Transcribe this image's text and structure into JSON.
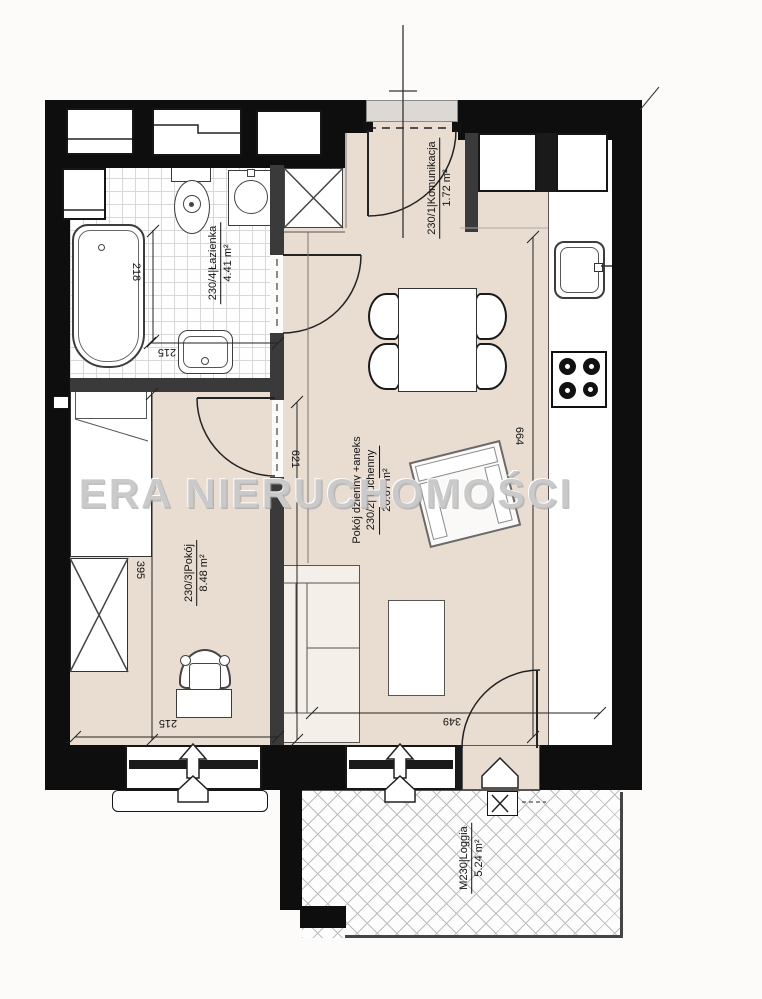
{
  "watermark": {
    "text": "ERA NIERUCHOMOŚCI"
  },
  "rooms": {
    "komunikacja": {
      "label": "230/1|Komunikacja",
      "area": "1.72 m²"
    },
    "living": {
      "label_line1": "Pokój dzienny +aneks",
      "label_line2": "230/2| kuchenny",
      "area": "20.67 m²"
    },
    "pokoj": {
      "label": "230/3|Pokój",
      "area": "8.48 m²"
    },
    "bathroom": {
      "label": "230/4|Łazienka",
      "area": "4.41 m²"
    },
    "loggia": {
      "label": "M230|Loggia",
      "area": "5.24 m²"
    }
  },
  "dimensions": {
    "bathtub_length": "218",
    "bathroom_width": "215",
    "pokoj_length": "395",
    "pokoj_width": "215",
    "living_length": "621",
    "kitchen_run": "664",
    "living_width": "349"
  }
}
